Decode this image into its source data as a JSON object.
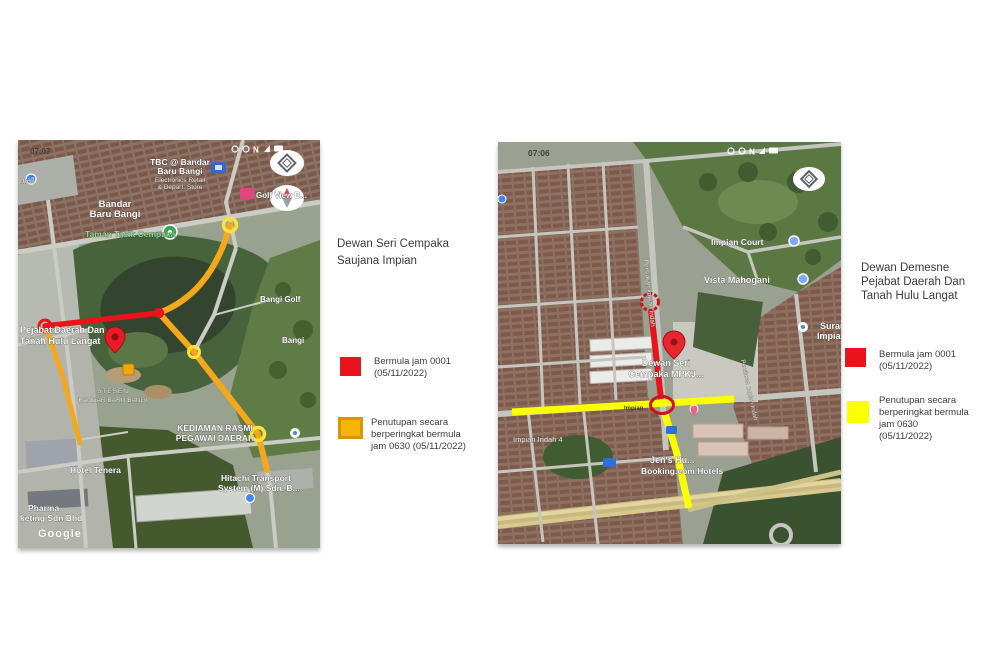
{
  "left": {
    "title": {
      "line1": "Dewan Seri Cempaka",
      "line2": "Saujana Impian"
    },
    "legend": {
      "red": {
        "line1": "Bermula jam 0001",
        "line2": "(05/11/2022)"
      },
      "orange": {
        "line1": "Penutupan secara",
        "line2": "berperingkat bermula",
        "line3": "jam 0630 (05/11/2022)"
      }
    },
    "map": {
      "time": "07:07",
      "compass_n": "N",
      "labels": {
        "mall": "mall",
        "tbc1": "TBC @ Bandar",
        "tbc2": "Baru Bangi",
        "tbc3": "Electronics Retail",
        "tbc4": "& Depart. Store",
        "bandar1": "Bandar",
        "bandar2": "Baru Bangi",
        "taman": "Taman Tasik Cempaka",
        "golfview": "Golf View B...",
        "bangigolf": "Bangi Golf",
        "bangi": "Bangi",
        "pejabat1": "Pejabat Daerah Dan",
        "pejabat2": "Tanah Hulu Langat",
        "stesen1": "STESEN",
        "stesen2": "BANDAR BARU BANGI",
        "kediaman1": "KEDIAMAN RASMI",
        "kediaman2": "PEGAWAI DAERAH",
        "hotel": "Hotel Tenera",
        "hitachi1": "Hitachi Transport",
        "hitachi2": "System (M) Sdn. B...",
        "pharma1": "Pharma",
        "pharma2": "keting Sdn Bhd",
        "google": "Google"
      }
    }
  },
  "right": {
    "title": {
      "line1": "Dewan Demesne",
      "line2": "Pejabat Daerah Dan",
      "line3": "Tanah Hulu Langat"
    },
    "legend": {
      "red": {
        "line1": "Bermula jam 0001",
        "line2": "(05/11/2022)"
      },
      "yellow": {
        "line1": "Penutupan secara",
        "line2": "berperingkat bermula",
        "line3": "jam 0630",
        "line4": "(05/11/2022)"
      }
    },
    "map": {
      "time": "07:06",
      "compass_n": "N",
      "labels": {
        "impiancourt": "Impian Court",
        "vista": "Vista Mahogani",
        "persiaran": "Persiaran Impian Indah",
        "dewan1": "Dewan Seri",
        "dewan2": "Cempaka MPKJ...",
        "impianroad": "Impian",
        "surau1": "Surau",
        "surau2": "Impian",
        "indah4": "Impian Indah 4",
        "jens1": "Jen's Hu...",
        "jens2": "Booking.com Hotels",
        "persiaran2": "Persiaran Impian Indah"
      }
    }
  },
  "colors": {
    "closure_red": "#e9131c",
    "closure_orange": "#f6b409",
    "closure_orange_border": "#db9404",
    "closure_yellow": "#fcff00",
    "route_orange": "#f5a81c",
    "route_red": "#e8131b"
  }
}
